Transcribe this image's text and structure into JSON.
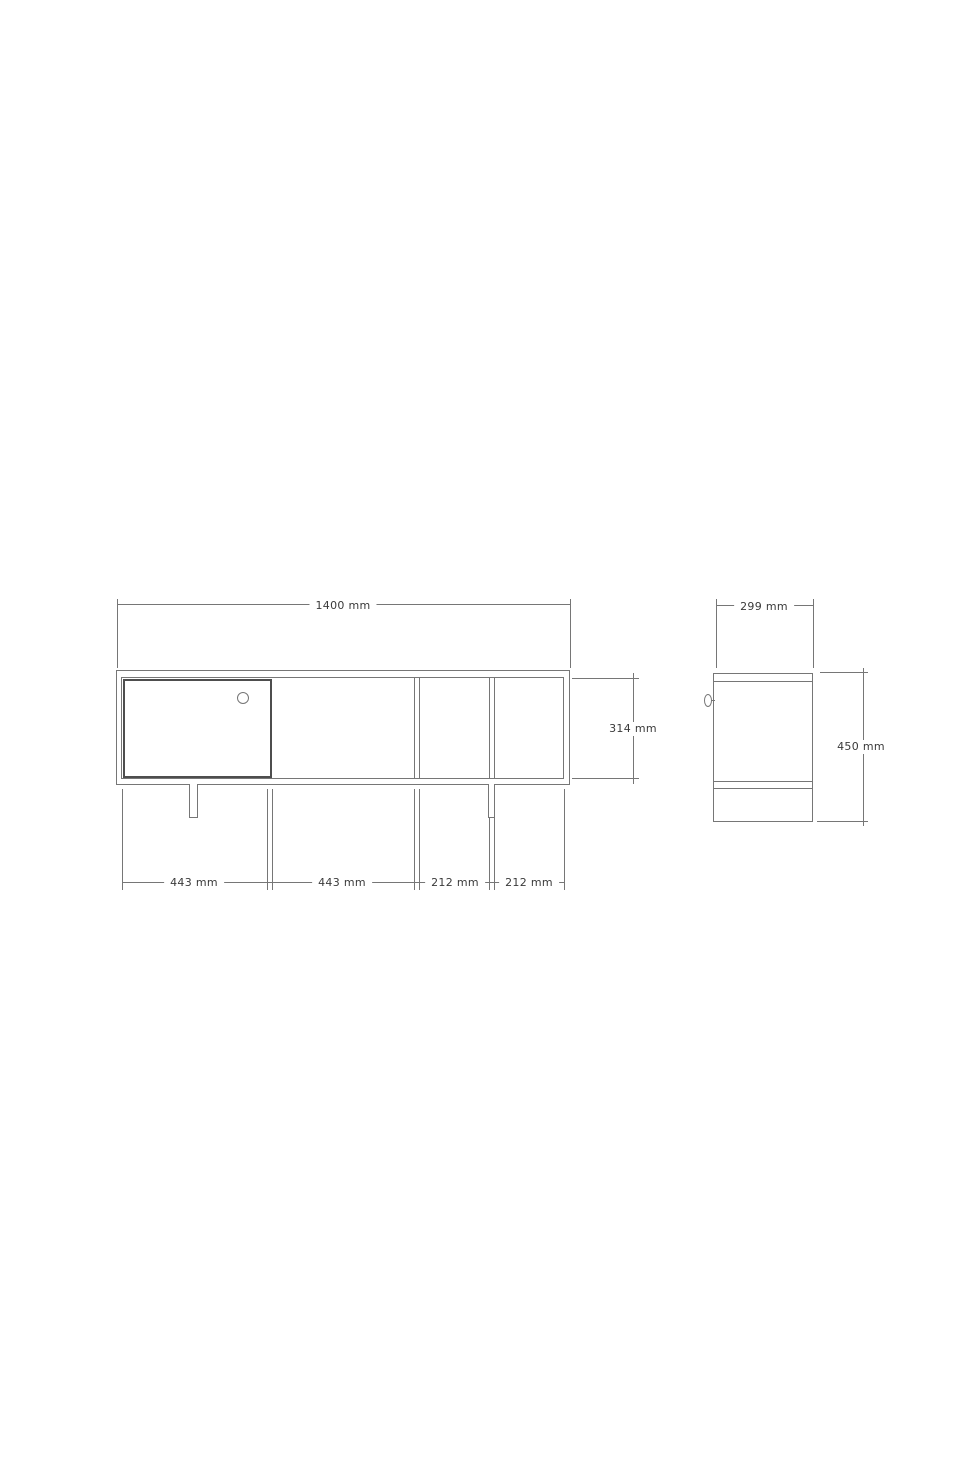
{
  "colors": {
    "background": "#ffffff",
    "line": "#767676",
    "door_line": "#4e4e4e",
    "text": "#3a3a3a"
  },
  "front_view": {
    "width_label": "1400 mm",
    "height_label": "314 mm",
    "segment_labels": [
      "443 mm",
      "443 mm",
      "212 mm",
      "212 mm"
    ]
  },
  "side_view": {
    "depth_label": "299 mm",
    "height_label": "450 mm"
  }
}
